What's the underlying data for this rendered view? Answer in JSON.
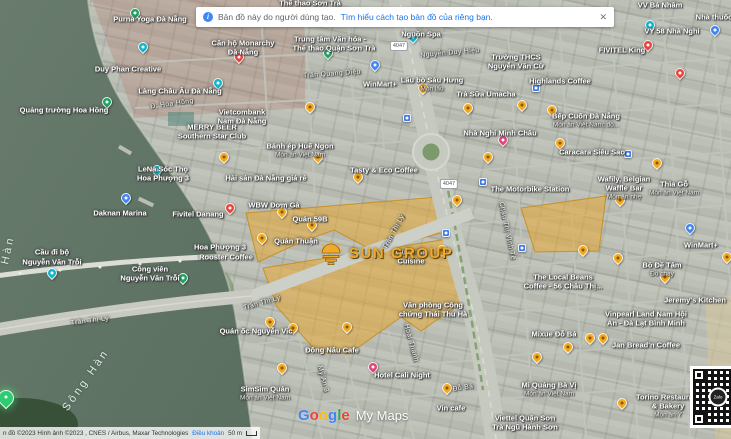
{
  "ui": {
    "banner": {
      "text": "Bản đồ này do người dùng tạo.",
      "link": "Tìm hiểu cách tạo bản đồ của riêng bạn.",
      "close": "✕",
      "info_glyph": "i"
    },
    "attribution": {
      "imagery": "n đồ ©2023 Hình ảnh ©2023 , CNES / Airbus, Maxar Technologies",
      "terms": "Điều khoản",
      "scale": "50 m"
    },
    "watermark": {
      "letters": [
        {
          "c": "G",
          "color": "#4285F4"
        },
        {
          "c": "o",
          "color": "#EA4335"
        },
        {
          "c": "o",
          "color": "#FBBC05"
        },
        {
          "c": "g",
          "color": "#4285F4"
        },
        {
          "c": "l",
          "color": "#34A853"
        },
        {
          "c": "e",
          "color": "#EA4335"
        }
      ],
      "suffix": "My Maps"
    },
    "qr": {
      "center_label": "Zalo"
    }
  },
  "overlay": {
    "sun_logo_text": "SUN GROUP",
    "colors": {
      "gold_overlay": "#E8A62D",
      "brand_gold": "#F0A928",
      "water": "#5F7263",
      "road": "#C6C9C0",
      "link_blue": "#1A73E8"
    }
  },
  "map": {
    "shields": [
      {
        "t": "4047",
        "x": 399,
        "y": 46
      },
      {
        "t": "4047",
        "x": 449,
        "y": 184
      }
    ],
    "labels": [
      {
        "t": "Thể thao Sơn Trà",
        "x": 310,
        "y": 3
      },
      {
        "t": "Purna Yoga Đà Nẵng",
        "x": 150,
        "y": 19
      },
      {
        "t": "Căn hộ Monarchy",
        "x": 243,
        "y": 43
      },
      {
        "t": "Đà Nẵng",
        "x": 243,
        "y": 52
      },
      {
        "t": "Duy Phan Creative",
        "x": 128,
        "y": 69
      },
      {
        "t": "Làng Châu Âu Đà Nẵng",
        "x": 180,
        "y": 91
      },
      {
        "t": "Đ. Hoa Hồng",
        "x": 172,
        "y": 104,
        "c": "s",
        "r": -8
      },
      {
        "t": "Quảng trường Hoa Hồng",
        "x": 64,
        "y": 110
      },
      {
        "t": "MERRY BEER",
        "x": 212,
        "y": 127
      },
      {
        "t": "Southern Star Club",
        "x": 212,
        "y": 136
      },
      {
        "t": "Vietcombank",
        "x": 242,
        "y": 112
      },
      {
        "t": "Nam Đà Nẵng",
        "x": 242,
        "y": 121
      },
      {
        "t": "Nguồn Spa",
        "x": 421,
        "y": 34
      },
      {
        "t": "Nguyễn Duy Hiệu",
        "x": 450,
        "y": 53,
        "c": "s",
        "r": -5
      },
      {
        "t": "Trường THCS",
        "x": 516,
        "y": 57
      },
      {
        "t": "Nguyễn Văn Cừ",
        "x": 516,
        "y": 66
      },
      {
        "t": "VY 58 Nhà Nghỉ",
        "x": 672,
        "y": 31
      },
      {
        "t": "Nhà thuốc",
        "x": 714,
        "y": 17
      },
      {
        "t": "VV Bá Nhâm",
        "x": 660,
        "y": 5
      },
      {
        "t": "FIVITEL King",
        "x": 622,
        "y": 50
      },
      {
        "t": "Lẩu bò Sáu Hưng",
        "x": 432,
        "y": 80
      },
      {
        "t": "Món lẩu",
        "x": 432,
        "y": 89,
        "c": "sm"
      },
      {
        "t": "Trà Sữa Umacha",
        "x": 486,
        "y": 94
      },
      {
        "t": "Highlands Coffee",
        "x": 560,
        "y": 81
      },
      {
        "t": "Trần Quang Diệu",
        "x": 332,
        "y": 74,
        "c": "s",
        "r": -4
      },
      {
        "t": "WinMart+",
        "x": 380,
        "y": 84
      },
      {
        "t": "Trung tâm Văn hóa -",
        "x": 330,
        "y": 39
      },
      {
        "t": "Thể thao Quận Sơn Trà",
        "x": 334,
        "y": 48
      },
      {
        "t": "Bếp Cuốn Đà Nẵng",
        "x": 586,
        "y": 116
      },
      {
        "t": "Món ăn Việt Nam; đồ...",
        "x": 586,
        "y": 125,
        "c": "sm"
      },
      {
        "t": "Nhà Nghỉ Minh Châu",
        "x": 500,
        "y": 133
      },
      {
        "t": "Caracara Siêu Sao",
        "x": 592,
        "y": 152
      },
      {
        "t": "Bánh ép Huế Ngon",
        "x": 300,
        "y": 146
      },
      {
        "t": "Món ăn Việt Nam",
        "x": 300,
        "y": 155,
        "c": "sm"
      },
      {
        "t": "Hải sản Đà Nẵng giá rẻ",
        "x": 266,
        "y": 178
      },
      {
        "t": "Tasty & Eco Coffee",
        "x": 384,
        "y": 170
      },
      {
        "t": "The Motorbike Station",
        "x": 530,
        "y": 189
      },
      {
        "t": "Wafily, Belgian",
        "x": 624,
        "y": 179
      },
      {
        "t": "Waffle Bar",
        "x": 624,
        "y": 188
      },
      {
        "t": "Món ăn nhẹ",
        "x": 624,
        "y": 197,
        "c": "sm"
      },
      {
        "t": "Thìa Gỗ",
        "x": 674,
        "y": 184
      },
      {
        "t": "Món ăn Việt Nam",
        "x": 674,
        "y": 193,
        "c": "sm"
      },
      {
        "t": "WBW Đơm Gà",
        "x": 274,
        "y": 205
      },
      {
        "t": "Quán 59B",
        "x": 310,
        "y": 219
      },
      {
        "t": "Quán Thuận",
        "x": 296,
        "y": 241
      },
      {
        "t": "LeNa Sóc Thọ",
        "x": 163,
        "y": 169
      },
      {
        "t": "Hoa Phượng 3",
        "x": 163,
        "y": 178
      },
      {
        "t": "Daknan Marina",
        "x": 120,
        "y": 213
      },
      {
        "t": "Fivitel Danang",
        "x": 198,
        "y": 214
      },
      {
        "t": "Hoa Phượng 3",
        "x": 220,
        "y": 247
      },
      {
        "t": "Rooster Coffee",
        "x": 226,
        "y": 257
      },
      {
        "t": "Cầu đi bộ",
        "x": 52,
        "y": 252
      },
      {
        "t": "Nguyễn Văn Trỗi",
        "x": 52,
        "y": 262
      },
      {
        "t": "Công viên",
        "x": 150,
        "y": 269
      },
      {
        "t": "Nguyễn Văn Trỗi",
        "x": 150,
        "y": 278
      },
      {
        "t": "Trần Thị Lý",
        "x": 90,
        "y": 321,
        "c": "s",
        "r": -7
      },
      {
        "t": "Trần Thị Lý",
        "x": 394,
        "y": 232,
        "c": "s",
        "r": -62
      },
      {
        "t": "Trần Thị Lý",
        "x": 262,
        "y": 303,
        "c": "s",
        "r": -16
      },
      {
        "t": "Sông Hàn",
        "x": 86,
        "y": 380,
        "c": "w",
        "r": -55
      },
      {
        "t": "Hàn",
        "x": 8,
        "y": 250,
        "c": "w",
        "r": -78
      },
      {
        "t": "Quán ốc Nguyễn Vic",
        "x": 256,
        "y": 331
      },
      {
        "t": "Đông Nâu Cafe",
        "x": 332,
        "y": 350
      },
      {
        "t": "Hotel Cali Night",
        "x": 402,
        "y": 375
      },
      {
        "t": "SimSim Quán",
        "x": 265,
        "y": 389
      },
      {
        "t": "Món ăn Việt Nam",
        "x": 265,
        "y": 398,
        "c": "sm"
      },
      {
        "t": "Mỹ An 3",
        "x": 323,
        "y": 379,
        "c": "s",
        "r": 75
      },
      {
        "t": "Châu Thị Vĩnh Tế",
        "x": 507,
        "y": 231,
        "c": "s",
        "r": 78
      },
      {
        "t": "Hoài Thanh",
        "x": 411,
        "y": 343,
        "c": "s",
        "r": 75
      },
      {
        "t": "Đỗ Bá",
        "x": 463,
        "y": 388,
        "c": "s",
        "r": -8
      },
      {
        "t": "Quán Bà",
        "x": 411,
        "y": 252
      },
      {
        "t": "Cuisine",
        "x": 411,
        "y": 261
      },
      {
        "t": "Bồ Đề Tâm",
        "x": 662,
        "y": 265
      },
      {
        "t": "Đồ chay",
        "x": 662,
        "y": 274,
        "c": "sm"
      },
      {
        "t": "WinMart+",
        "x": 701,
        "y": 245
      },
      {
        "t": "The Local Beans",
        "x": 563,
        "y": 277
      },
      {
        "t": "Coffee - 56 Châu Thị...",
        "x": 563,
        "y": 286
      },
      {
        "t": "Jeremy's Kitchen",
        "x": 695,
        "y": 300
      },
      {
        "t": "Vinpearl Land Nam Hội",
        "x": 646,
        "y": 314
      },
      {
        "t": "An - Đà Lạt Bình Minh",
        "x": 646,
        "y": 323
      },
      {
        "t": "Văn phòng Công",
        "x": 433,
        "y": 305
      },
      {
        "t": "chứng Thái Thu Hà",
        "x": 433,
        "y": 314
      },
      {
        "t": "Mixue Đỗ Bá",
        "x": 554,
        "y": 334
      },
      {
        "t": "Jan Bread'n Coffee",
        "x": 646,
        "y": 345
      },
      {
        "t": "Mì Quảng Bà Vị",
        "x": 549,
        "y": 385
      },
      {
        "t": "Món ăn Việt Nam",
        "x": 549,
        "y": 394,
        "c": "sm"
      },
      {
        "t": "Torino Restaurant",
        "x": 668,
        "y": 397
      },
      {
        "t": "& Bakery",
        "x": 668,
        "y": 406
      },
      {
        "t": "Món ăn Ý",
        "x": 668,
        "y": 415,
        "c": "sm"
      },
      {
        "t": "Vin cafe",
        "x": 451,
        "y": 408
      },
      {
        "t": "Viettel Quận Sơn",
        "x": 525,
        "y": 418
      },
      {
        "t": "Trà Ngũ Hành Sơn",
        "x": 525,
        "y": 427
      }
    ],
    "pins": [
      {
        "x": 262,
        "y": 243,
        "k": "y"
      },
      {
        "x": 282,
        "y": 217,
        "k": "y"
      },
      {
        "x": 312,
        "y": 230,
        "k": "y"
      },
      {
        "x": 318,
        "y": 162,
        "k": "y"
      },
      {
        "x": 358,
        "y": 182,
        "k": "y"
      },
      {
        "x": 310,
        "y": 112,
        "k": "y"
      },
      {
        "x": 423,
        "y": 93,
        "k": "y"
      },
      {
        "x": 468,
        "y": 113,
        "k": "y"
      },
      {
        "x": 522,
        "y": 110,
        "k": "y"
      },
      {
        "x": 552,
        "y": 115,
        "k": "y"
      },
      {
        "x": 488,
        "y": 162,
        "k": "y"
      },
      {
        "x": 560,
        "y": 148,
        "k": "y"
      },
      {
        "x": 657,
        "y": 168,
        "k": "y"
      },
      {
        "x": 457,
        "y": 205,
        "k": "y"
      },
      {
        "x": 620,
        "y": 205,
        "k": "y"
      },
      {
        "x": 442,
        "y": 255,
        "k": "y"
      },
      {
        "x": 583,
        "y": 255,
        "k": "y"
      },
      {
        "x": 618,
        "y": 263,
        "k": "y"
      },
      {
        "x": 665,
        "y": 282,
        "k": "y"
      },
      {
        "x": 727,
        "y": 262,
        "k": "y"
      },
      {
        "x": 224,
        "y": 162,
        "k": "y"
      },
      {
        "x": 270,
        "y": 327,
        "k": "y"
      },
      {
        "x": 293,
        "y": 333,
        "k": "y"
      },
      {
        "x": 347,
        "y": 332,
        "k": "y"
      },
      {
        "x": 282,
        "y": 373,
        "k": "y"
      },
      {
        "x": 447,
        "y": 393,
        "k": "y"
      },
      {
        "x": 537,
        "y": 362,
        "k": "y"
      },
      {
        "x": 568,
        "y": 352,
        "k": "y"
      },
      {
        "x": 590,
        "y": 343,
        "k": "y"
      },
      {
        "x": 603,
        "y": 343,
        "k": "y"
      },
      {
        "x": 622,
        "y": 408,
        "k": "y"
      },
      {
        "x": 230,
        "y": 213,
        "k": "re"
      },
      {
        "x": 648,
        "y": 50,
        "k": "re"
      },
      {
        "x": 239,
        "y": 62,
        "k": "re"
      },
      {
        "x": 680,
        "y": 78,
        "k": "re"
      },
      {
        "x": 503,
        "y": 145,
        "k": "pk"
      },
      {
        "x": 373,
        "y": 372,
        "k": "pk"
      },
      {
        "x": 143,
        "y": 52,
        "k": "tl"
      },
      {
        "x": 218,
        "y": 88,
        "k": "tl"
      },
      {
        "x": 157,
        "y": 175,
        "k": "tl"
      },
      {
        "x": 52,
        "y": 278,
        "k": "tl"
      },
      {
        "x": 413,
        "y": 42,
        "k": "tl"
      },
      {
        "x": 650,
        "y": 30,
        "k": "tl"
      },
      {
        "x": 135,
        "y": 18,
        "k": "gn"
      },
      {
        "x": 107,
        "y": 107,
        "k": "gn"
      },
      {
        "x": 328,
        "y": 58,
        "k": "gn"
      },
      {
        "x": 183,
        "y": 283,
        "k": "gn"
      },
      {
        "x": 375,
        "y": 70,
        "k": "bl"
      },
      {
        "x": 690,
        "y": 233,
        "k": "bl"
      },
      {
        "x": 715,
        "y": 35,
        "k": "bl"
      },
      {
        "x": 126,
        "y": 203,
        "k": "bl"
      },
      {
        "x": 407,
        "y": 122,
        "k": "sq"
      },
      {
        "x": 446,
        "y": 237,
        "k": "sq"
      },
      {
        "x": 522,
        "y": 252,
        "k": "sq"
      },
      {
        "x": 536,
        "y": 92,
        "k": "sq"
      },
      {
        "x": 483,
        "y": 186,
        "k": "sq"
      },
      {
        "x": 628,
        "y": 158,
        "k": "sq"
      },
      {
        "x": 6,
        "y": 406,
        "k": "bg"
      }
    ]
  }
}
